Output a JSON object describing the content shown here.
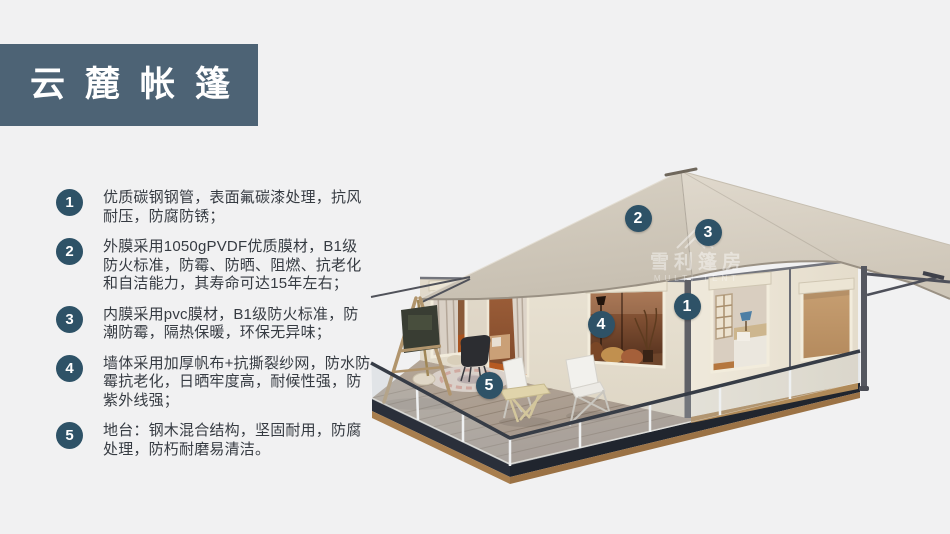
{
  "colors": {
    "page_bg": "#f1f1f2",
    "banner_bg": "#4d6375",
    "banner_text": "#ffffff",
    "marker": "#2e5267",
    "body_text": "#363b42",
    "roof_beige": "#d6cec1",
    "wall_cream": "#eae3d4",
    "deck_fascia": "#2a2f3a",
    "deck_wood_base": "#a87e4e",
    "rail_dark": "#363c46"
  },
  "header": {
    "title": "云麓帐篷"
  },
  "features": {
    "items": [
      {
        "num": "1",
        "text": "优质碳钢钢管，表面氟碳漆处理，抗风耐压，防腐防锈；"
      },
      {
        "num": "2",
        "text": "外膜采用1050gPVDF优质膜材，B1级防火标准，防霉、防晒、阻燃、抗老化和自洁能力，其寿命可达15年左右；"
      },
      {
        "num": "3",
        "text": "内膜采用pvc膜材，B1级防火标准，防潮防霉，隔热保暖，环保无异味；"
      },
      {
        "num": "4",
        "text": "墙体采用加厚帆布+抗撕裂纱网，防水防霉抗老化，日晒牢度高，耐候性强，防紫外线强；"
      },
      {
        "num": "5",
        "text": "地台：钢木混合结构，坚固耐用，防腐处理，防朽耐磨易清洁。"
      }
    ]
  },
  "illustration": {
    "watermark": {
      "cn": "雪利篷房",
      "en": "MULTI TENT"
    },
    "callouts": [
      {
        "num": "1",
        "x": 327,
        "y": 156
      },
      {
        "num": "2",
        "x": 278,
        "y": 68
      },
      {
        "num": "3",
        "x": 348,
        "y": 82
      },
      {
        "num": "4",
        "x": 241,
        "y": 174
      },
      {
        "num": "5",
        "x": 129,
        "y": 235
      }
    ]
  }
}
